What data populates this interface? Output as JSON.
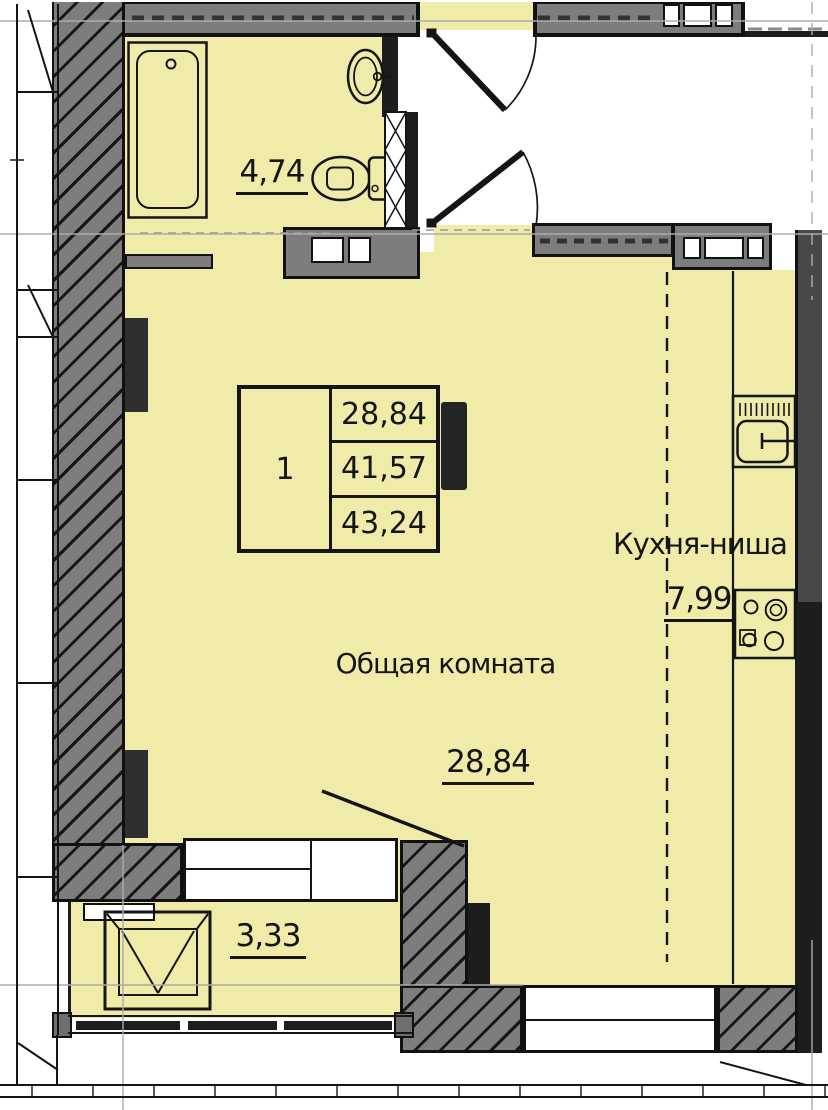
{
  "plan": {
    "info_table": {
      "apartment_number": "1",
      "rows": [
        "28,84",
        "41,57",
        "43,24"
      ]
    },
    "labels": {
      "bathroom_area": "4,74",
      "kitchen_name": "Кухня-ниша",
      "kitchen_area": "7,99",
      "living_name": "Общая комната",
      "living_area": "28,84",
      "loggia_area": "3,33"
    },
    "colors": {
      "floor_fill": "#f1eba9",
      "corridor_fill": "#ffffff",
      "wall_gray": "#7d7d7d",
      "wall_dark": "#1d1d1d",
      "line_black": "#151515",
      "grid_gray": "#ababab"
    }
  }
}
